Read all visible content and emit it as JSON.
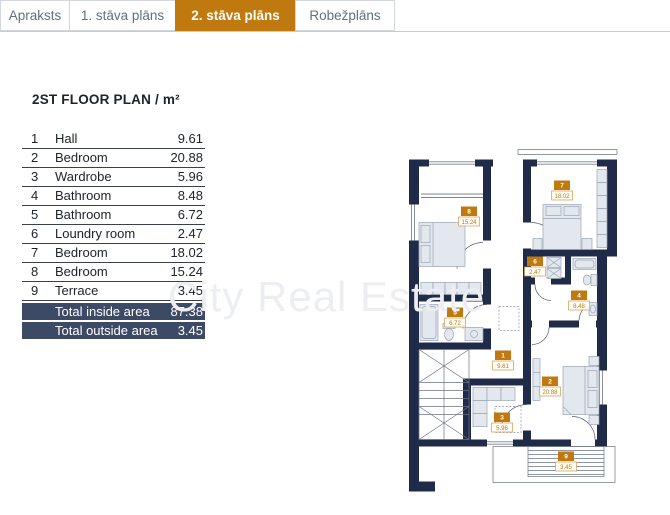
{
  "tabs": [
    {
      "label": "Apraksts",
      "active": false
    },
    {
      "label": "1. stāva plāns",
      "active": false
    },
    {
      "label": "2. stāva plāns",
      "active": true
    },
    {
      "label": "Robežplāns",
      "active": false
    }
  ],
  "title": "2ST FLOOR PLAN / m²",
  "rooms_table": {
    "rows": [
      {
        "num": "1",
        "name": "Hall",
        "area": "9.61"
      },
      {
        "num": "2",
        "name": "Bedroom",
        "area": "20.88"
      },
      {
        "num": "3",
        "name": "Wardrobe",
        "area": "5.96"
      },
      {
        "num": "4",
        "name": "Bathroom",
        "area": "8.48"
      },
      {
        "num": "5",
        "name": "Bathroom",
        "area": "6.72"
      },
      {
        "num": "6",
        "name": "Loundry room",
        "area": "2.47"
      },
      {
        "num": "7",
        "name": "Bedroom",
        "area": "18.02"
      },
      {
        "num": "8",
        "name": "Bedroom",
        "area": "15.24"
      },
      {
        "num": "9",
        "name": "Terrace",
        "area": "3.45"
      }
    ],
    "totals": [
      {
        "label": "Total inside area",
        "value": "87.38"
      },
      {
        "label": "Total outside area",
        "value": "3.45"
      }
    ]
  },
  "watermark": "City Real Estate",
  "colors": {
    "accent": "#c0790f",
    "accent_border": "#cf9a4a",
    "tab_text": "#5e7082",
    "total_bar": "#3d4a66",
    "wall": "#202a49",
    "table_line": "#3a3f4b",
    "text": "#20242e"
  }
}
